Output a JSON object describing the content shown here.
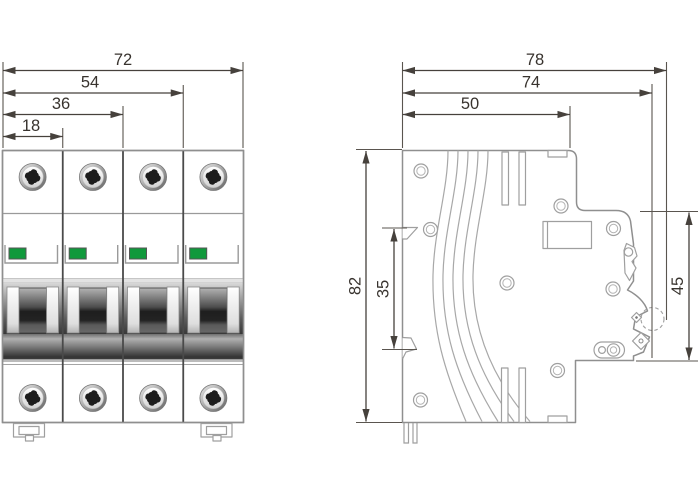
{
  "drawing": {
    "subject": "4-pole din-rail circuit breaker dimension drawing",
    "front_view": {
      "pole_count": 4,
      "width_dims": [
        {
          "value": "72"
        },
        {
          "value": "54"
        },
        {
          "value": "36"
        },
        {
          "value": "18"
        }
      ]
    },
    "side_view": {
      "depth_dims": [
        {
          "value": "78"
        },
        {
          "value": "74"
        },
        {
          "value": "50"
        }
      ],
      "height_dims": [
        {
          "value": "82"
        },
        {
          "value": "35"
        },
        {
          "value": "45"
        }
      ]
    },
    "colors": {
      "indicator_green": "#10993c",
      "dimension_line": "#46413c",
      "body_outline": "#8f8f8f"
    }
  }
}
